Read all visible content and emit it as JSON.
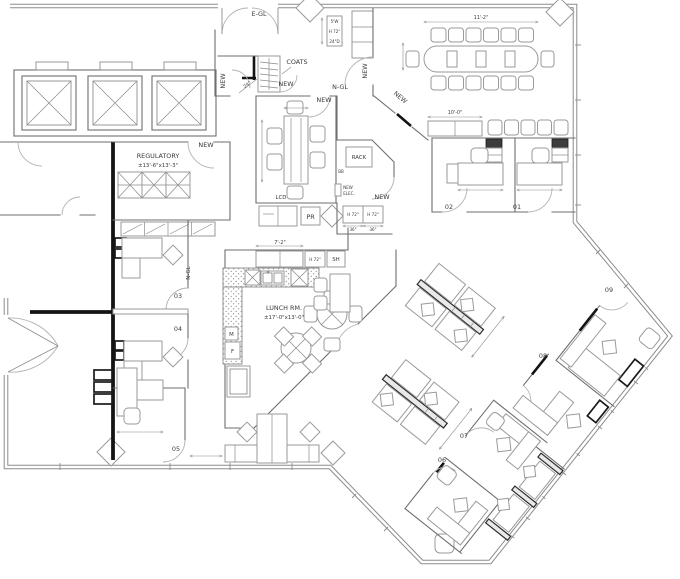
{
  "labels": {
    "e_gl": "E-GL",
    "coats": "COATS",
    "n_gl": "N-GL",
    "n_gl2": "N-GL",
    "new1": "NEW",
    "new2": "NEW",
    "new3": "NEW",
    "new4": "NEW",
    "new5": "NEW",
    "new6": "NEW",
    "new7": "NEW",
    "rack": "RACK",
    "bb": "BB",
    "new_elec1": "NEW",
    "new_elec2": "ELEC.",
    "lcd": "LCD",
    "pr": "PR",
    "sh": "SH",
    "m": "M",
    "f": "F",
    "h72a": "H 72\"",
    "h72b": "H 72\"",
    "h72c": "H 72\"",
    "regulatory": "REGULATORY",
    "regulatory_dims": "±13'-6\"x13'-3\"",
    "lunch": "LUNCH RM.",
    "lunch_dims": "±17'-0\"x13'-0\""
  },
  "dims": {
    "d24": "24\"",
    "d10_0": "10'-0\"",
    "d11_2": "11'-2\"",
    "d7_2": "7'-2\"",
    "d36a": "36\"",
    "d36b": "36\"",
    "cab_w": "5'W",
    "cab_h": "H 72\"",
    "cab_d": "24\"D"
  },
  "offices": {
    "o1": "01",
    "o2": "02",
    "o3": "03",
    "o4": "04",
    "o5": "05",
    "o6": "06",
    "o7": "07",
    "o8": "08",
    "o9": "09"
  }
}
